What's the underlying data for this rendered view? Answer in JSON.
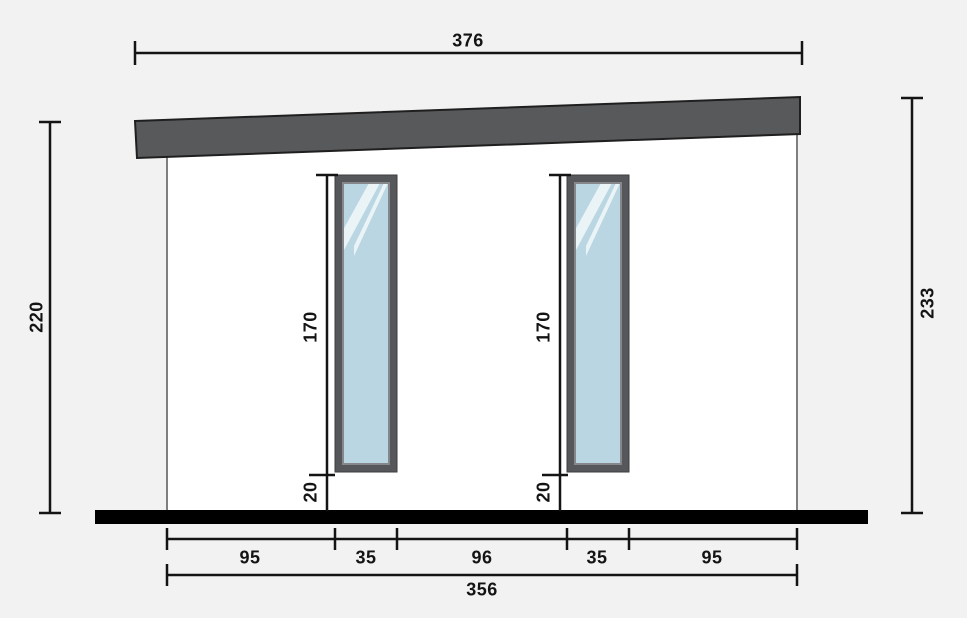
{
  "scene": {
    "description": "Side elevation diagram of a flat mono-pitch roof building with two tall narrow windows, floor slab and dimension lines"
  },
  "colors": {
    "background": "#f2f2f2",
    "wall_fill": "#ffffff",
    "wall_stroke": "#7f7f7f",
    "roof_fill": "#58595b",
    "roof_stroke": "#1f1f1f",
    "window_frame": "#56575a",
    "window_frame_inner": "#85878a",
    "glass": "#b9d6e2",
    "glare": "#ffffff",
    "floor": "#000000",
    "dimension": "#141414"
  },
  "dims": {
    "roof_width": "376",
    "wall_height_left": "220",
    "overall_height_right": "233",
    "window1_height": "170",
    "window2_height": "170",
    "window1_bottom_offset": "20",
    "window2_bottom_offset": "20",
    "bottom_segments": [
      "95",
      "35",
      "96",
      "35",
      "95"
    ],
    "base_width_total": "356"
  }
}
